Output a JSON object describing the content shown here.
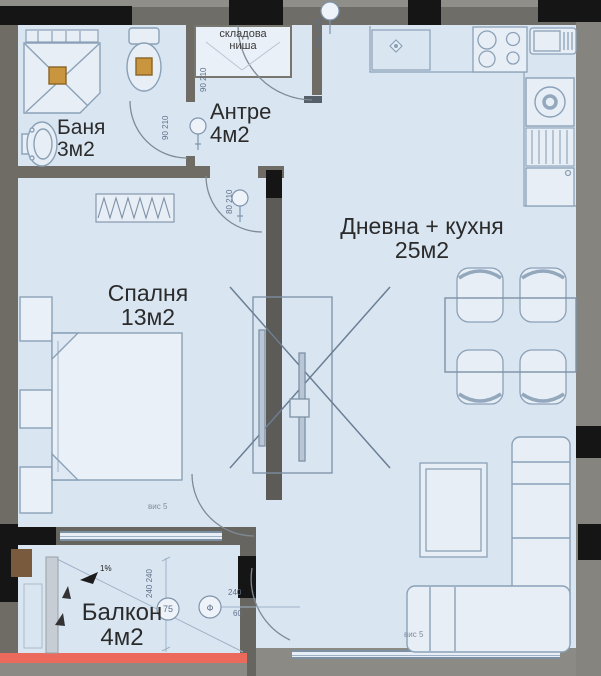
{
  "plan_title": "Apartment floor plan",
  "colors": {
    "floor": "#d9e6f2",
    "wall": "#66655f",
    "column": "#151515",
    "railing": "#ec6a5c",
    "fixture_accent": "#c9953f",
    "furniture_line": "#8ba1b7"
  },
  "labels": {
    "bathroom": {
      "name": "Баня",
      "area": "3м2"
    },
    "entry": {
      "name": "Антре",
      "area": "4м2"
    },
    "living": {
      "name": "Дневна + кухня",
      "area": "25м2"
    },
    "bedroom": {
      "name": "Спалня",
      "area": "13м2"
    },
    "balcony": {
      "name": "Балкон",
      "area": "4м2"
    },
    "storage_niche": {
      "line1": "складова",
      "line2": "ниша"
    }
  },
  "annotations": {
    "door_bath": "90 210",
    "door_bedroom": "80 210",
    "door_entry": "100 210",
    "niche_dim": "90 210",
    "balcony_dim": "240 240",
    "balcony_circle_left": "75",
    "balcony_circle_right": "Ф",
    "dim_240": "240",
    "dim_60": "60",
    "note_bedroom": "вис 5",
    "note_sofa": "вис 5",
    "slope": "1%"
  }
}
